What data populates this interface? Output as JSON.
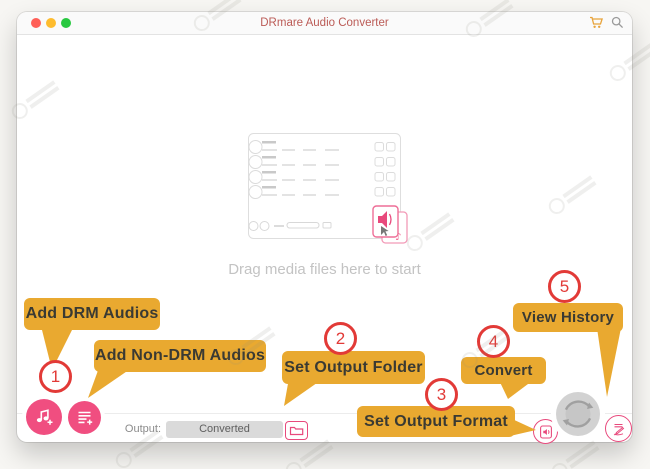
{
  "colors": {
    "accent_pink": "#f04e80",
    "pink_outline": "#e8497c",
    "callout_yellow": "#e9a930",
    "step_red": "#e23a37",
    "title_red": "#bb5b56",
    "cart_orange": "#e8a33b",
    "convert_gray": "#d2d2d2"
  },
  "titlebar": {
    "title": "DRmare Audio Converter",
    "window_controls": [
      "close",
      "minimize",
      "zoom"
    ],
    "icons": [
      "cart-icon",
      "search-icon"
    ]
  },
  "dropzone": {
    "hint": "Drag media files here to start"
  },
  "toolbar": {
    "output_label": "Output:",
    "output_folder": "Converted",
    "buttons": [
      "add-drm-audios-button",
      "add-non-drm-audios-button",
      "choose-output-folder-button",
      "output-format-button",
      "convert-button",
      "history-button"
    ]
  },
  "steps": [
    "1",
    "2",
    "3",
    "4",
    "5"
  ],
  "callouts": [
    {
      "step": "1",
      "label": "Add DRM Audios"
    },
    {
      "step": "1",
      "label": "Add Non-DRM Audios"
    },
    {
      "step": "2",
      "label": "Set Output Folder"
    },
    {
      "step": "3",
      "label": "Set Output Format"
    },
    {
      "step": "4",
      "label": "Convert"
    },
    {
      "step": "5",
      "label": "View History"
    }
  ],
  "icons": [
    "music-note-plus-icon",
    "list-plus-icon",
    "folder-icon",
    "speaker-document-icon",
    "sync-arrows-icon",
    "list-pen-icon",
    "speaker-icon",
    "music-note-icon",
    "cart-icon",
    "search-icon"
  ]
}
